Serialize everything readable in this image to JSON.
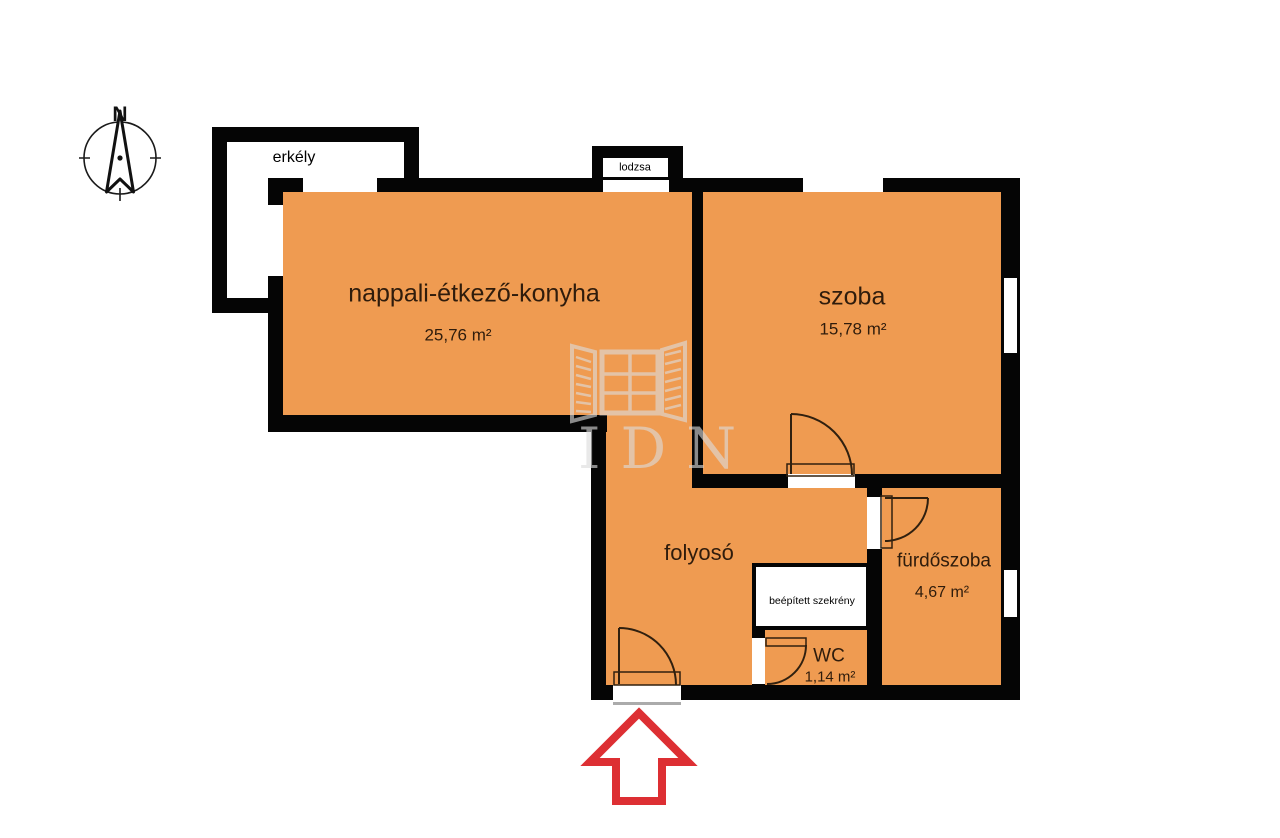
{
  "compass": {
    "north_label": "N"
  },
  "balcony": {
    "label": "erkély"
  },
  "loggia": {
    "label": "lodzsa"
  },
  "rooms": {
    "living": {
      "name": "nappali-étkező-konyha",
      "area": "25,76 m²"
    },
    "bedroom": {
      "name": "szoba",
      "area": "15,78 m²"
    },
    "hallway": {
      "name": "folyosó"
    },
    "bathroom": {
      "name": "fürdőszoba",
      "area": "4,67 m²"
    },
    "wc": {
      "name": "WC",
      "area": "1,14 m²"
    },
    "closet": {
      "name": "beépített szekrény"
    }
  },
  "watermark": {
    "letters": "IDN"
  },
  "colors": {
    "room_fill": "#ef9b51",
    "wall": "#050505",
    "entrance_arrow": "#dd2f33",
    "room_label": "#2f1c0c"
  }
}
